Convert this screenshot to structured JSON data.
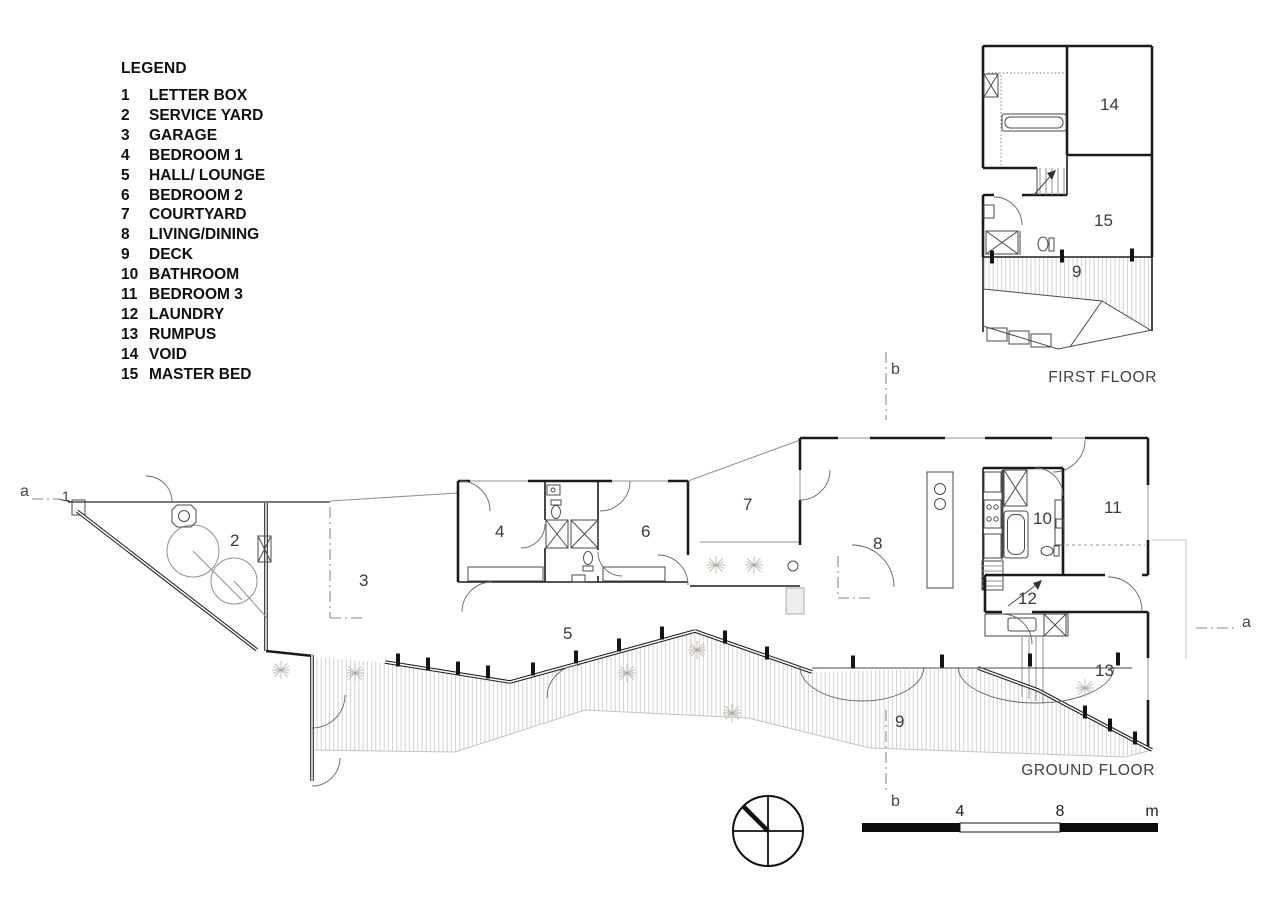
{
  "sheet": {
    "background": "#ffffff",
    "ink": "#1b1b1b",
    "muted_line": "#909090",
    "hatch_line": "#c6c6c6",
    "label_text": "#3a3a3a"
  },
  "legend": {
    "title": "LEGEND",
    "items": [
      {
        "num": "1",
        "label": "LETTER BOX"
      },
      {
        "num": "2",
        "label": "SERVICE YARD"
      },
      {
        "num": "3",
        "label": "GARAGE"
      },
      {
        "num": "4",
        "label": "BEDROOM 1"
      },
      {
        "num": "5",
        "label": "HALL/ LOUNGE"
      },
      {
        "num": "6",
        "label": "BEDROOM 2"
      },
      {
        "num": "7",
        "label": "COURTYARD"
      },
      {
        "num": "8",
        "label": "LIVING/DINING"
      },
      {
        "num": "9",
        "label": "DECK"
      },
      {
        "num": "10",
        "label": "BATHROOM"
      },
      {
        "num": "11",
        "label": "BEDROOM 3"
      },
      {
        "num": "12",
        "label": "LAUNDRY"
      },
      {
        "num": "13",
        "label": "RUMPUS"
      },
      {
        "num": "14",
        "label": "VOID"
      },
      {
        "num": "15",
        "label": "MASTER BED"
      }
    ]
  },
  "plans": {
    "first": {
      "caption": "FIRST FLOOR",
      "rooms": {
        "r9": "9",
        "r14": "14",
        "r15": "15"
      }
    },
    "ground": {
      "caption": "GROUND FLOOR",
      "rooms": {
        "r1": "1",
        "r2": "2",
        "r3": "3",
        "r4": "4",
        "r5": "5",
        "r6": "6",
        "r7": "7",
        "r8": "8",
        "r9": "9",
        "r10": "10",
        "r11": "11",
        "r12": "12",
        "r13": "13"
      }
    }
  },
  "markers": {
    "a": "a",
    "b": "b"
  },
  "scale_bar": {
    "tick_mid": "4",
    "tick_end": "8",
    "unit": "m"
  }
}
